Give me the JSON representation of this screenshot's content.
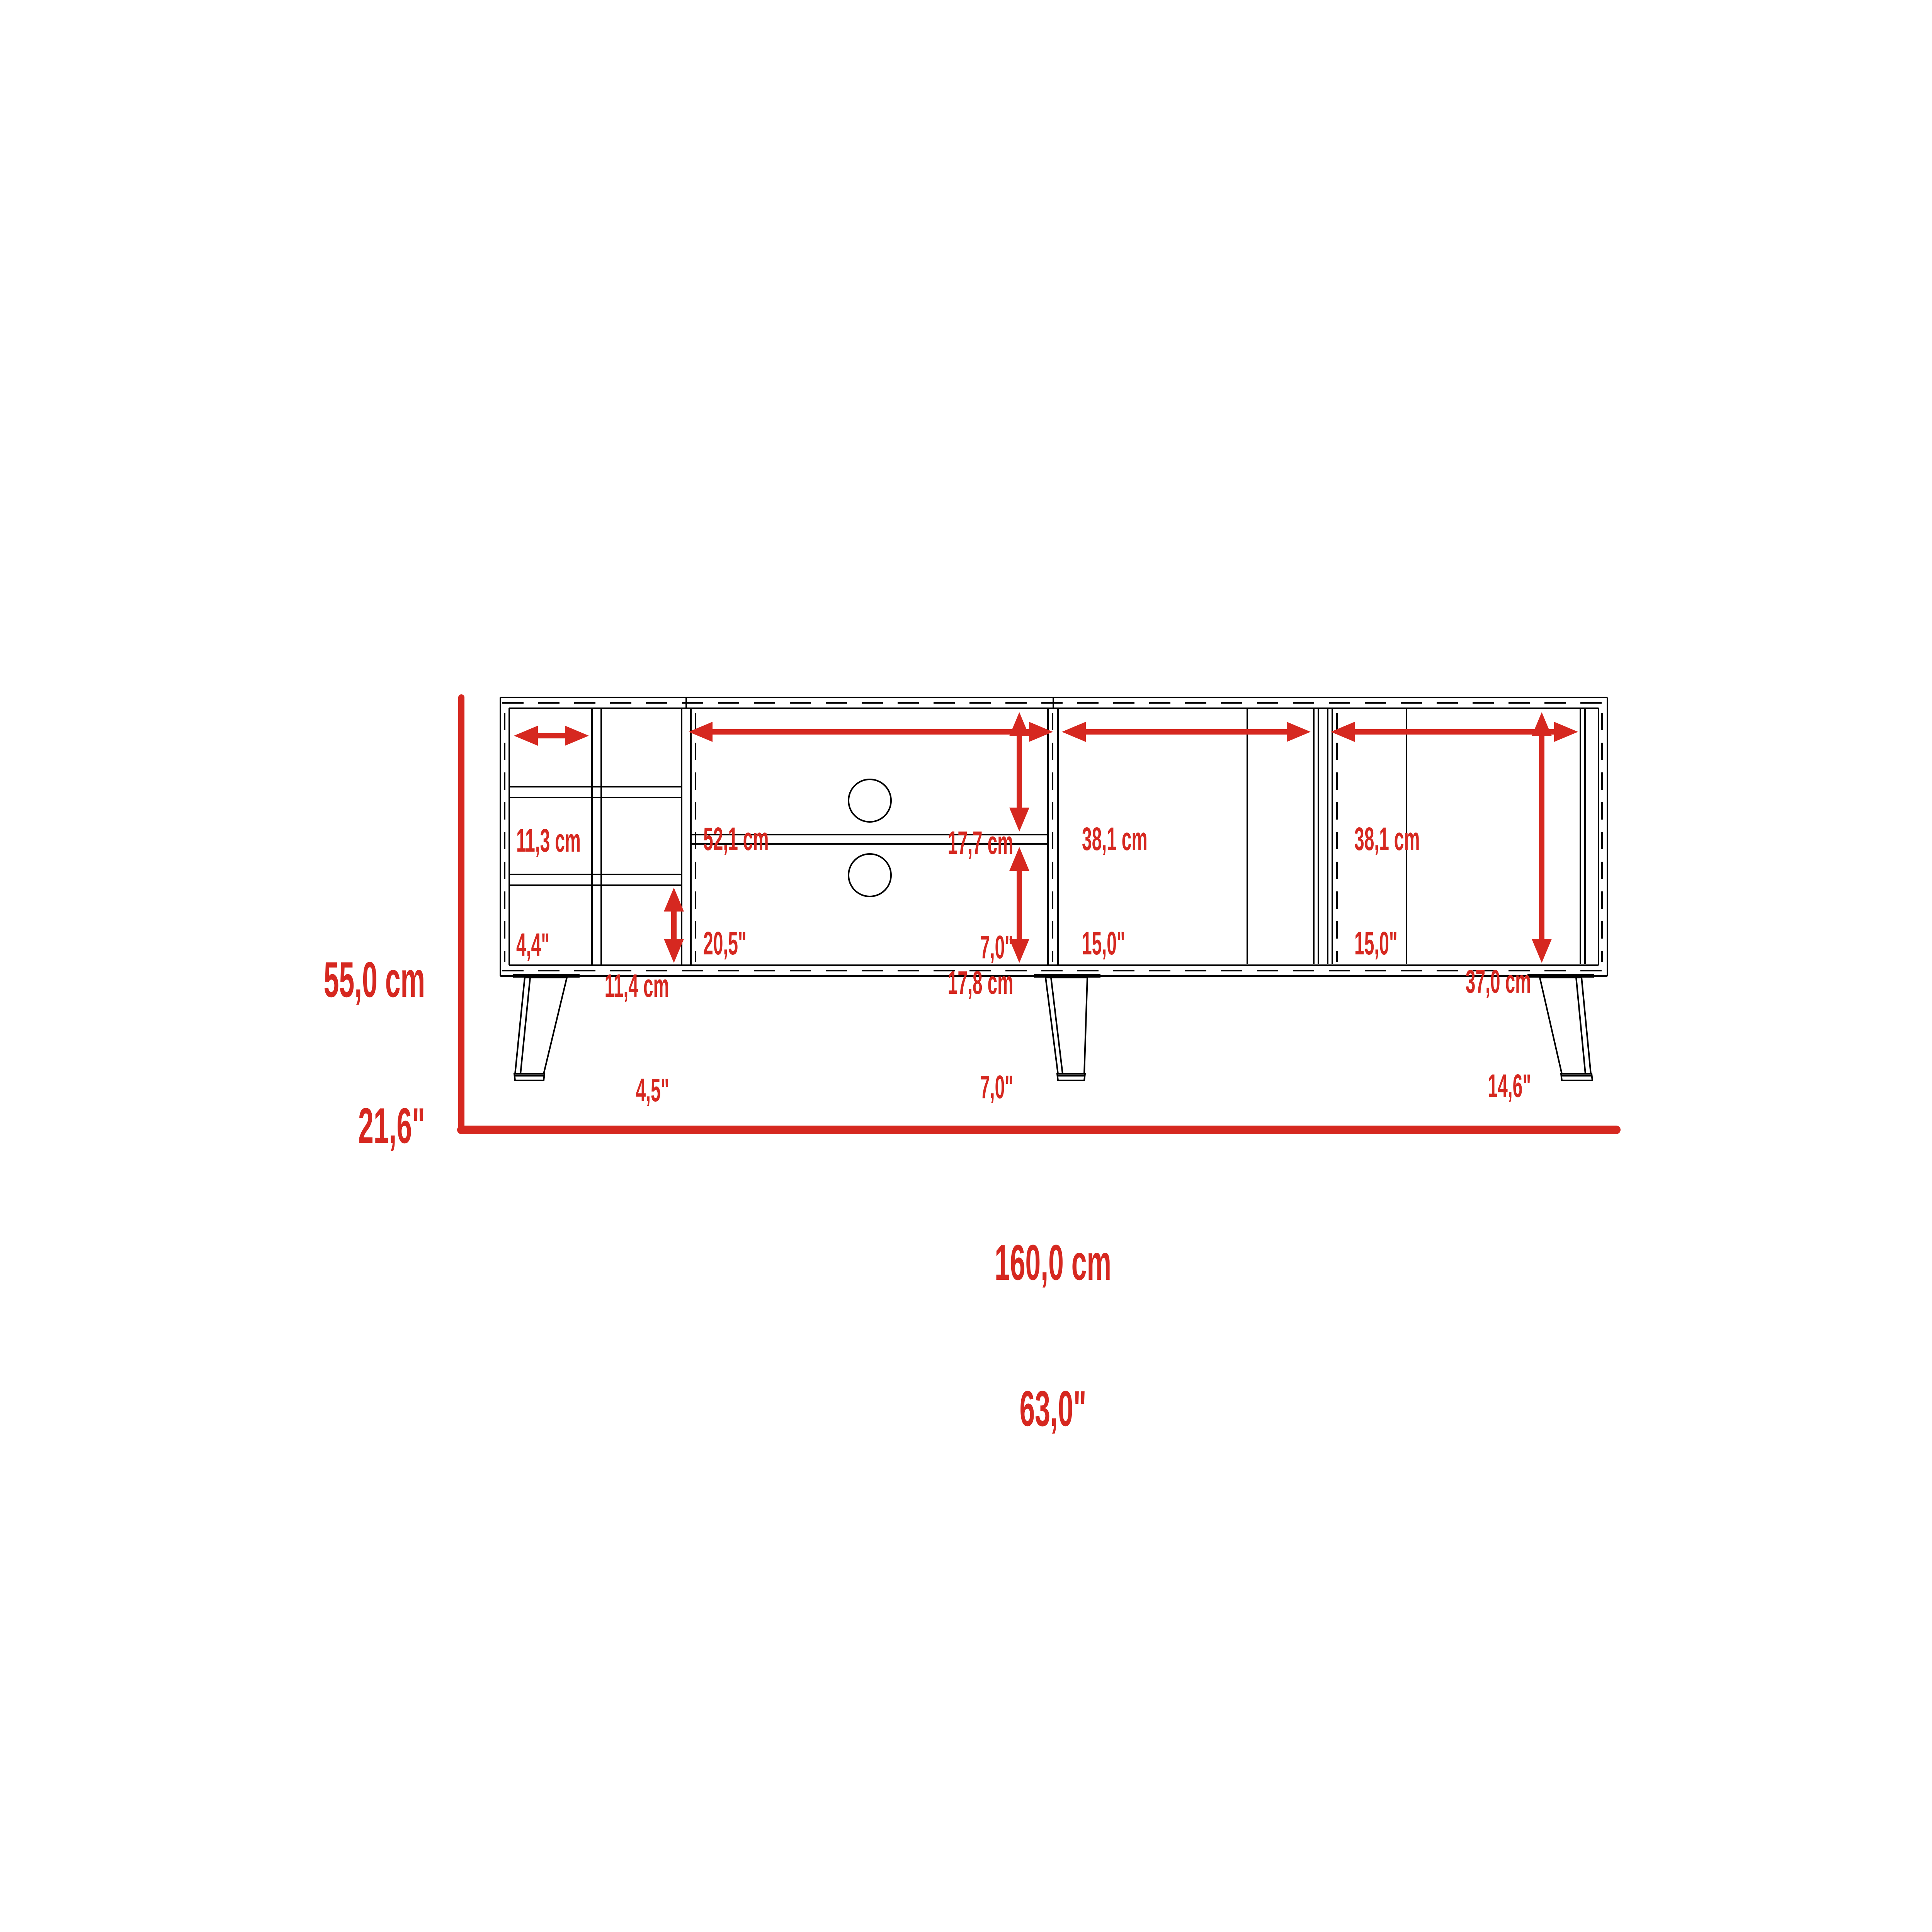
{
  "colors": {
    "dimension_red": "#d62820",
    "line_black": "#000000",
    "background": "#ffffff"
  },
  "dimensions": {
    "overall_width": {
      "cm": "160,0 cm",
      "inches": "63,0\""
    },
    "overall_height": {
      "cm": "55,0 cm",
      "inches": "21,6\""
    },
    "wine_cubby_width": {
      "cm": "11,3 cm",
      "inches": "4,4\""
    },
    "wine_cubby_height": {
      "cm": "11,4 cm",
      "inches": "4,5\""
    },
    "media_opening_width": {
      "cm": "52,1 cm",
      "inches": "20,5\""
    },
    "media_upper_height": {
      "cm": "17,7 cm",
      "inches": "7,0\""
    },
    "media_lower_height": {
      "cm": "17,8 cm",
      "inches": "7,0\""
    },
    "left_door_width": {
      "cm": "38,1 cm",
      "inches": "15,0\""
    },
    "right_door_width": {
      "cm": "38,1 cm",
      "inches": "15,0\""
    },
    "door_opening_height": {
      "cm": "37,0 cm",
      "inches": "14,6\""
    }
  }
}
